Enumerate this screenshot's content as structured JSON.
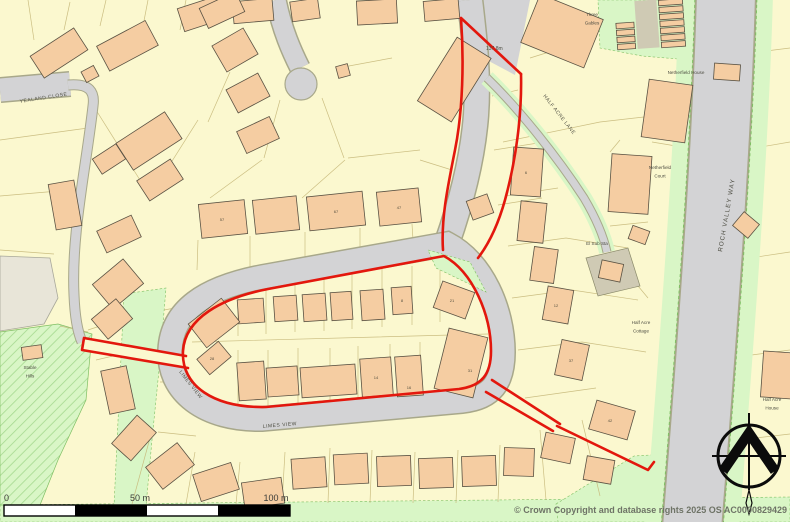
{
  "map": {
    "copyright": "© Crown Copyright and database rights 2025 OS AC0000829429",
    "spot_height": "137.8m",
    "scale_bar": {
      "zero": "0",
      "mid": "50 m",
      "end": "100 m"
    },
    "road_labels": {
      "yealand_close": "YEALAND CLOSE",
      "limes_view_west": "LIMES VIEW",
      "limes_view_south": "LIMES VIEW",
      "half_acre_lane": "HALF ACRE LANE",
      "roch_valley_way": "ROCH VALLEY WAY"
    },
    "place_labels": [
      {
        "id": "three-gables",
        "lines": [
          "Three",
          "Gables"
        ],
        "x": 592,
        "y": 16
      },
      {
        "id": "netherfield-house",
        "lines": [
          "Netherfield House"
        ],
        "x": 686,
        "y": 74
      },
      {
        "id": "netherfield-court",
        "lines": [
          "Netherfield",
          "Court"
        ],
        "x": 660,
        "y": 169
      },
      {
        "id": "el-sub-sta",
        "lines": [
          "El Sub Sta"
        ],
        "x": 597,
        "y": 245
      },
      {
        "id": "half-acre-cottage",
        "lines": [
          "Half Acre",
          "Cottage"
        ],
        "x": 641,
        "y": 324
      },
      {
        "id": "half-acre-house",
        "lines": [
          "Half Acre",
          "House"
        ],
        "x": 772,
        "y": 401
      },
      {
        "id": "stable-hills",
        "lines": [
          "Stable",
          "Hills"
        ],
        "x": 30,
        "y": 369
      }
    ],
    "plot_numbers": [
      {
        "t": "67",
        "x": 336,
        "y": 213
      },
      {
        "t": "47",
        "x": 399,
        "y": 209
      },
      {
        "t": "57",
        "x": 222,
        "y": 221
      },
      {
        "t": "8",
        "x": 402,
        "y": 302
      },
      {
        "t": "21",
        "x": 452,
        "y": 302
      },
      {
        "t": "14",
        "x": 376,
        "y": 379
      },
      {
        "t": "16",
        "x": 409,
        "y": 389
      },
      {
        "t": "31",
        "x": 470,
        "y": 372
      },
      {
        "t": "28",
        "x": 212,
        "y": 360
      },
      {
        "t": "12",
        "x": 556,
        "y": 307
      },
      {
        "t": "37",
        "x": 571,
        "y": 362
      },
      {
        "t": "42",
        "x": 610,
        "y": 422
      },
      {
        "t": "6",
        "x": 526,
        "y": 174
      }
    ],
    "colors": {
      "background": "#FBF8CF",
      "building": "#F5CDA2",
      "building_outline": "#5A5243",
      "road": "#D3D3D5",
      "road_casing": "#A8A88A",
      "green": "#D9F6C6",
      "green_line": "#7FBF63",
      "hatch_line": "#A5D98F",
      "boundary_red": "#E3170D",
      "out_of_plan": "#E8E5D8",
      "parcel_line": "#C8BB7D",
      "substation_plot": "#CFCAB4"
    }
  }
}
